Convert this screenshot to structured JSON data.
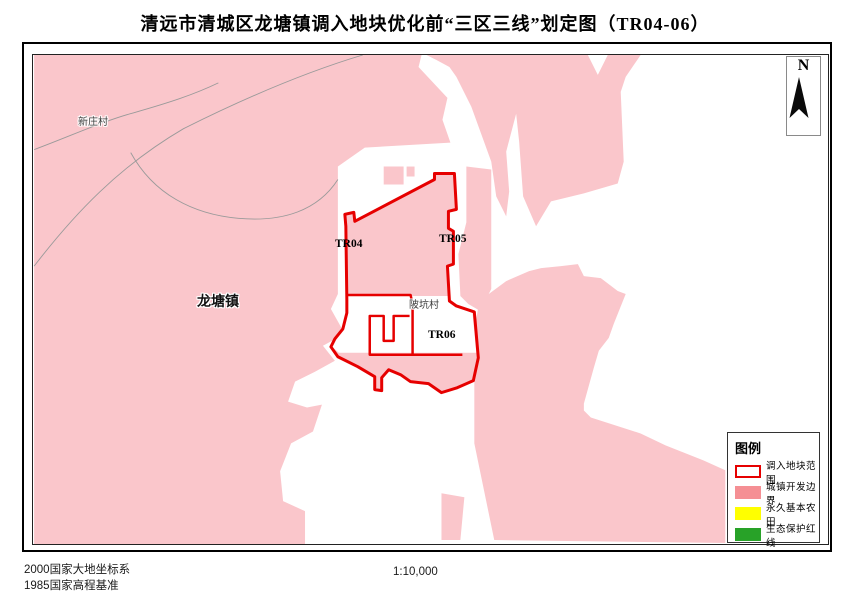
{
  "title": "清远市清城区龙塘镇调入地块优化前“三区三线”划定图（TR04-06）",
  "map": {
    "north_label": "N",
    "labels": {
      "village_nw": "新庄村",
      "town": "龙塘镇",
      "plot_tr04": "TR04",
      "plot_tr05": "TR05",
      "plot_tr06": "TR06",
      "village_center": "陂坑村"
    }
  },
  "legend": {
    "title": "图例",
    "items": [
      {
        "label": "调入地块范围",
        "swatch": "red-outline",
        "color": "#e60000"
      },
      {
        "label": "城镇开发边界",
        "swatch": "fill",
        "color": "#f58f94"
      },
      {
        "label": "永久基本农田",
        "swatch": "fill",
        "color": "#ffff00"
      },
      {
        "label": "生态保护红线",
        "swatch": "fill",
        "color": "#28a228"
      }
    ]
  },
  "footer": {
    "coordinate_system": "2000国家大地坐标系",
    "elevation_datum": "1985国家高程基准",
    "scale": "1:10,000"
  },
  "colors": {
    "development_boundary_fill": "#fac6cb",
    "plot_outline": "#e60000",
    "admin_boundary_line": "#9a9a9a"
  }
}
